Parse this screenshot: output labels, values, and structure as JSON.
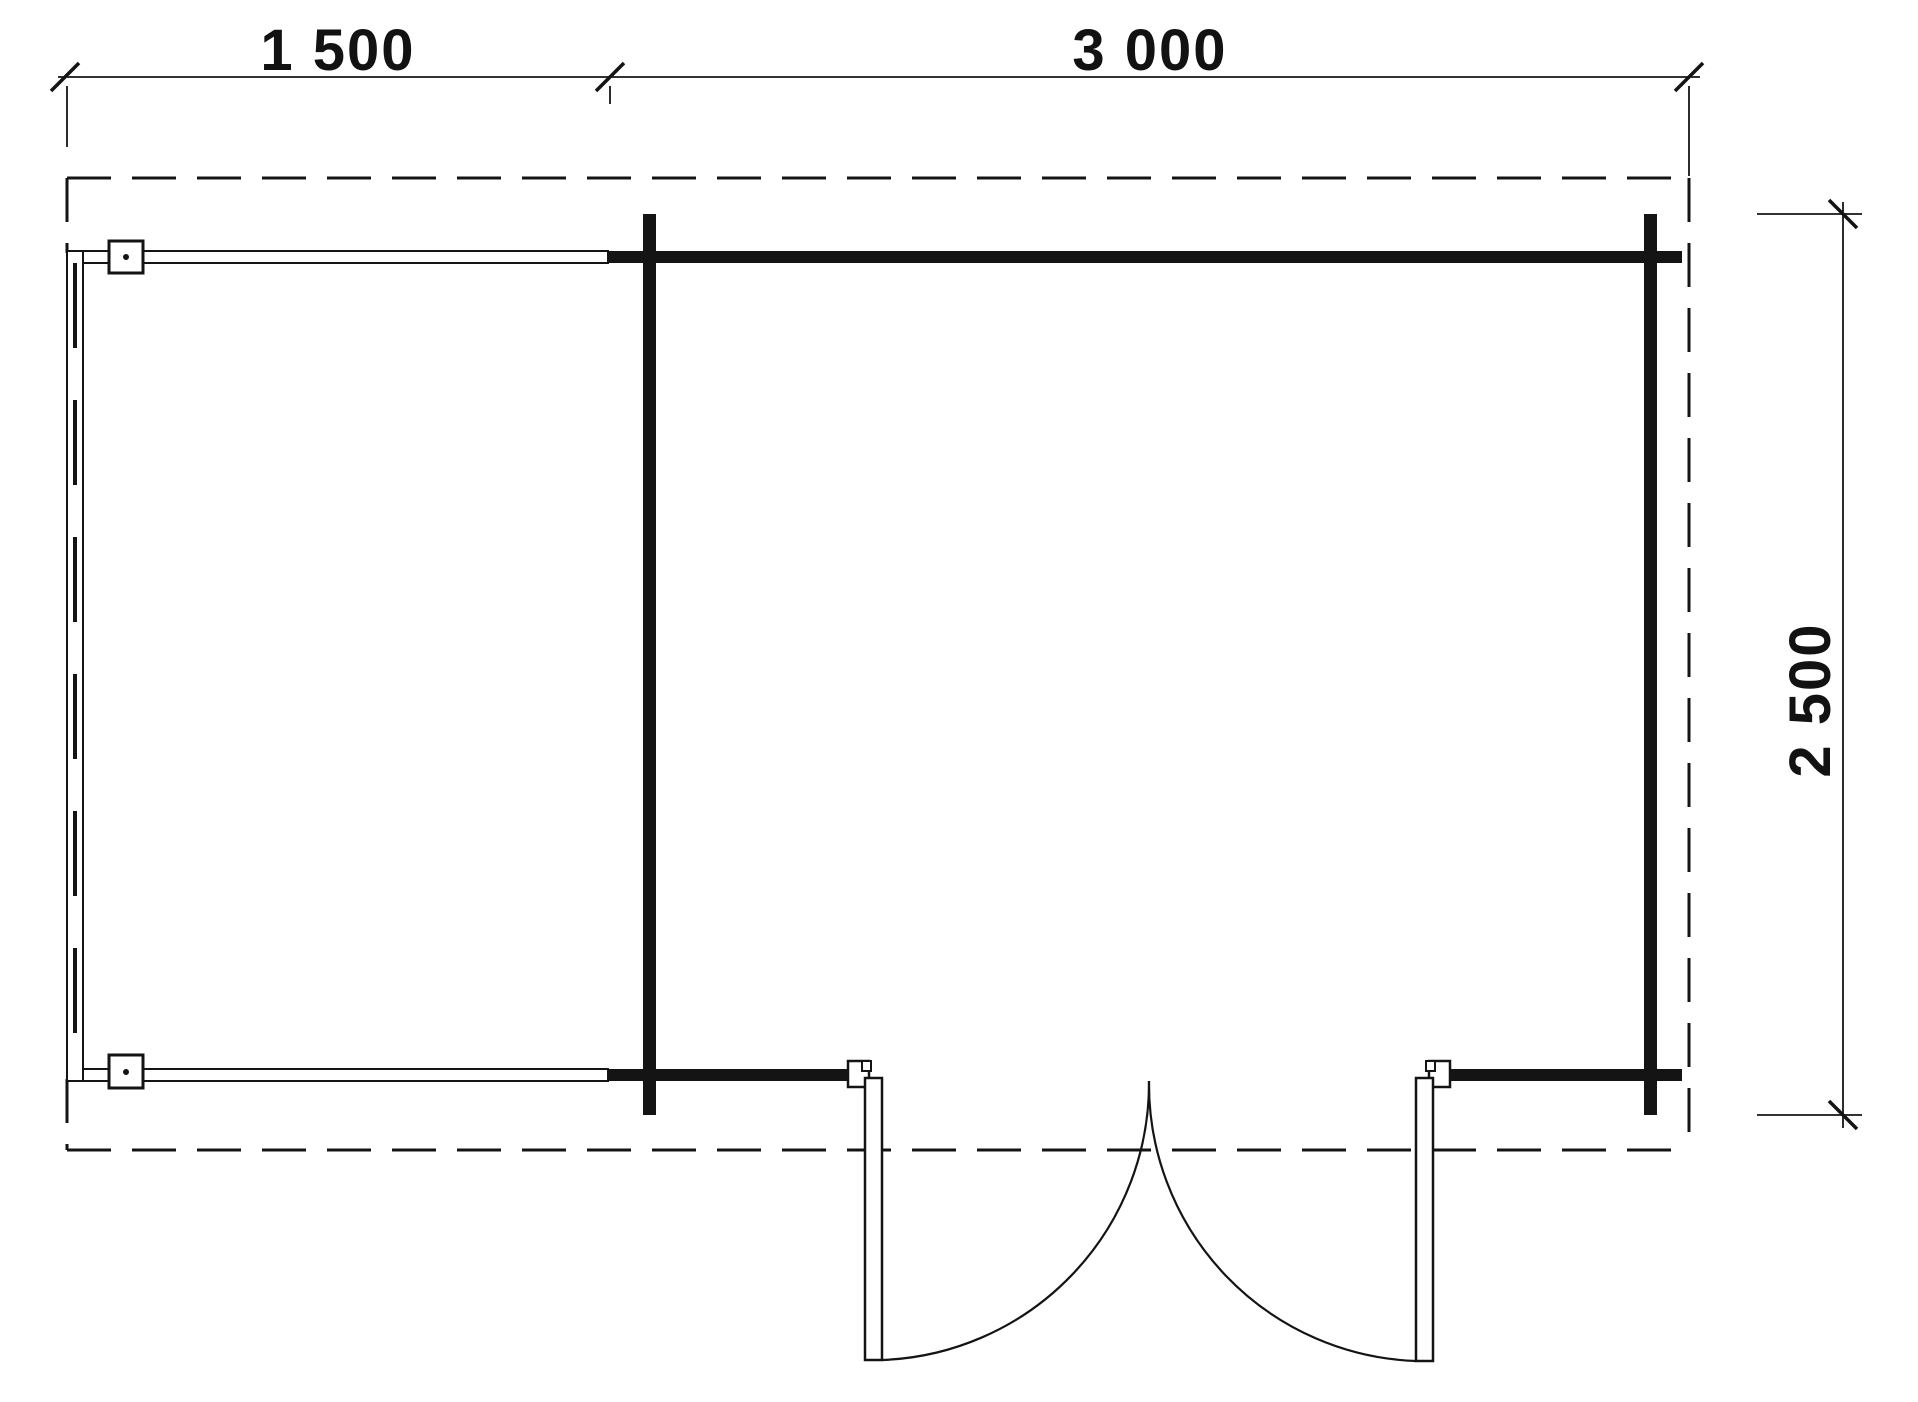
{
  "drawing": {
    "type": "floor-plan",
    "background_color": "#ffffff",
    "line_color": "#141414",
    "text_color": "#121212"
  },
  "dimensions": {
    "top_left_width": "1 500",
    "top_right_width": "3 000",
    "right_depth": "2 500"
  }
}
